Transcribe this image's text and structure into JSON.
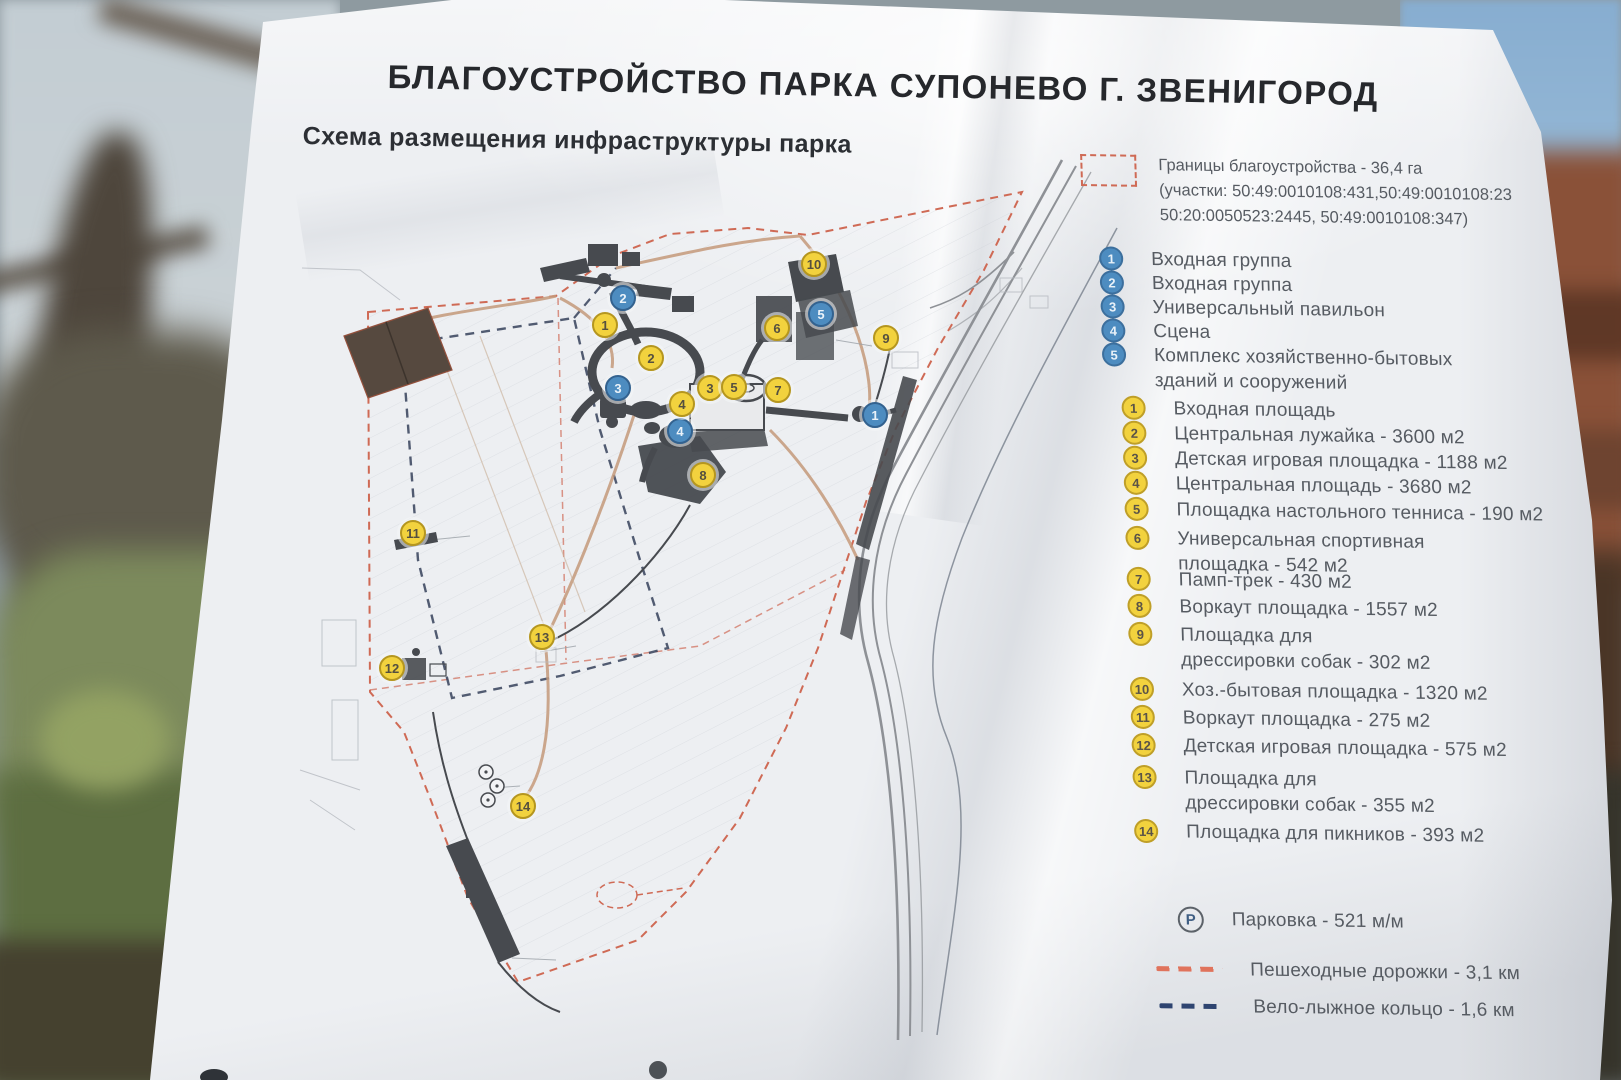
{
  "board": {
    "title": "БЛАГОУСТРОЙСТВО ПАРКА СУПОНЕВО Г. ЗВЕНИГОРОД",
    "subtitle": "Схема размещения инфраструктуры парка"
  },
  "legend": {
    "boundary": {
      "line1": "Границы благоустройства - 36,4 га",
      "line2": "(участки: 50:49:0010108:431,50:49:0010108:23",
      "line3": "50:20:0050523:2445, 50:49:0010108:347)"
    },
    "blue_items": [
      {
        "n": "1",
        "label": "Входная группа"
      },
      {
        "n": "2",
        "label": "Входная группа"
      },
      {
        "n": "3",
        "label": "Универсальный павильон"
      },
      {
        "n": "4",
        "label": "Сцена"
      },
      {
        "n": "5",
        "label": "Комплекс хозяйственно-бытовых",
        "label2": "зданий и сооружений"
      }
    ],
    "yellow_items": [
      {
        "n": "1",
        "label": "Входная площадь"
      },
      {
        "n": "2",
        "label": "Центральная лужайка - 3600 м2"
      },
      {
        "n": "3",
        "label": "Детская игровая площадка - 1188 м2"
      },
      {
        "n": "4",
        "label": "Центральная площадь - 3680 м2"
      },
      {
        "n": "5",
        "label": "Площадка настольного тенниса - 190 м2"
      },
      {
        "n": "6",
        "label": "Универсальная спортивная",
        "label2": "площадка - 542 м2"
      },
      {
        "n": "7",
        "label": "Памп-трек - 430 м2"
      },
      {
        "n": "8",
        "label": "Воркаут площадка - 1557 м2"
      },
      {
        "n": "9",
        "label": "Площадка для",
        "label2": "дрессировки собак - 302 м2"
      },
      {
        "n": "10",
        "label": "Хоз.-бытовая площадка - 1320 м2"
      },
      {
        "n": "11",
        "label": "Воркаут площадка - 275 м2"
      },
      {
        "n": "12",
        "label": "Детская игровая площадка - 575 м2"
      },
      {
        "n": "13",
        "label": "Площадка для",
        "label2": "дрессировки собак - 355 м2"
      },
      {
        "n": "14",
        "label": "Площадка для пикников - 393 м2"
      }
    ],
    "parking": {
      "symbol": "P",
      "label": "Парковка - 521 м/м"
    },
    "paths_item": {
      "label": "Пешеходные дорожки - 3,1 км"
    },
    "ski_item": {
      "label": "Вело-лыжное кольцо - 1,6 км"
    }
  },
  "map_markers": {
    "blue": [
      {
        "n": "1"
      },
      {
        "n": "2"
      },
      {
        "n": "3"
      },
      {
        "n": "4"
      },
      {
        "n": "5"
      }
    ],
    "yellow": [
      {
        "n": "1"
      },
      {
        "n": "2"
      },
      {
        "n": "3"
      },
      {
        "n": "4"
      },
      {
        "n": "5"
      },
      {
        "n": "6"
      },
      {
        "n": "7"
      },
      {
        "n": "8"
      },
      {
        "n": "9"
      },
      {
        "n": "10"
      },
      {
        "n": "11"
      },
      {
        "n": "12"
      },
      {
        "n": "13"
      },
      {
        "n": "14"
      }
    ]
  },
  "colors": {
    "marker_yellow": "#f2d23e",
    "marker_blue": "#4d8cc0",
    "boundary_red": "#cf6a55",
    "pedestrian_red": "#e0735c",
    "ski_navy": "#2e4470",
    "map_ink": "#474a4f"
  }
}
